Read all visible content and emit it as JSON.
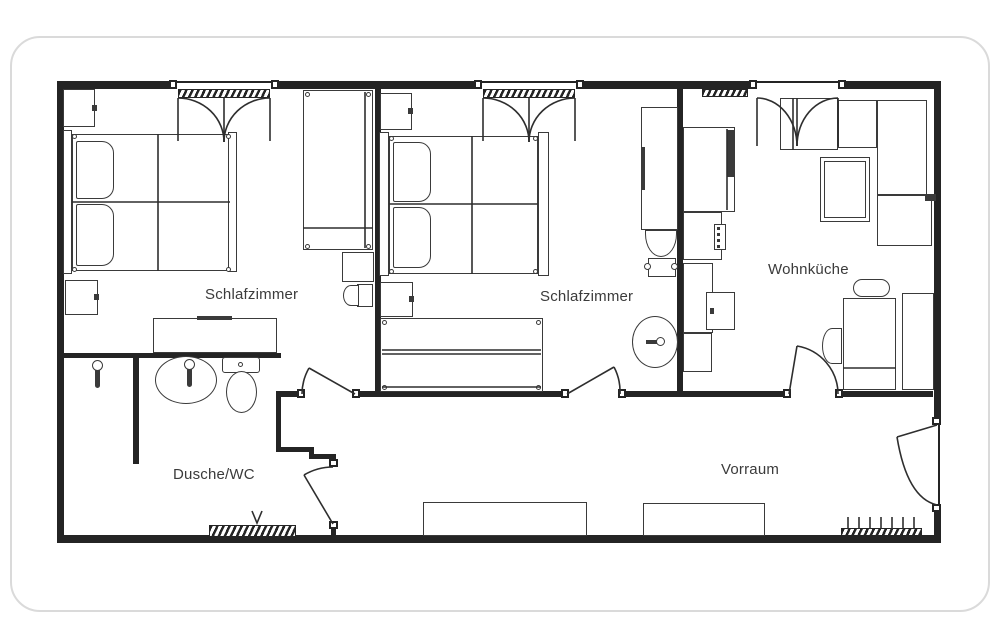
{
  "floorplan": {
    "type": "apartment-floor-plan",
    "rooms": {
      "bedroom1": {
        "label": "Schlafzimmer"
      },
      "bedroom2": {
        "label": "Schlafzimmer"
      },
      "kitchen": {
        "label": "Wohnküche"
      },
      "bath": {
        "label": "Dusche/WC"
      },
      "hall": {
        "label": "Vorraum"
      }
    },
    "colors": {
      "wall": "#242424",
      "furniture_line": "#3a3a3a",
      "label_text": "#3b3b3b",
      "background": "#ffffff"
    }
  }
}
